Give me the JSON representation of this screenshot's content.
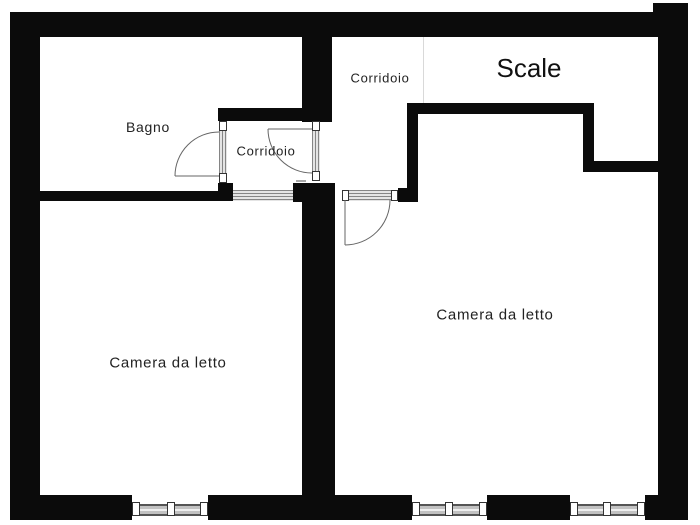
{
  "floorplan": {
    "labels": {
      "bagno": "Bagno",
      "corridoio_small": "Corridoio",
      "corridoio_top": "Corridoio",
      "scale": "Scale",
      "camera_da_letto_left": "Camera da letto",
      "camera_da_letto_right": "Camera da letto"
    },
    "colors": {
      "wall": "#0b0b0b",
      "background": "#ffffff",
      "label_text": "#222222",
      "door_swing_line": "#666666",
      "window_band": "#c2c2c2"
    }
  }
}
